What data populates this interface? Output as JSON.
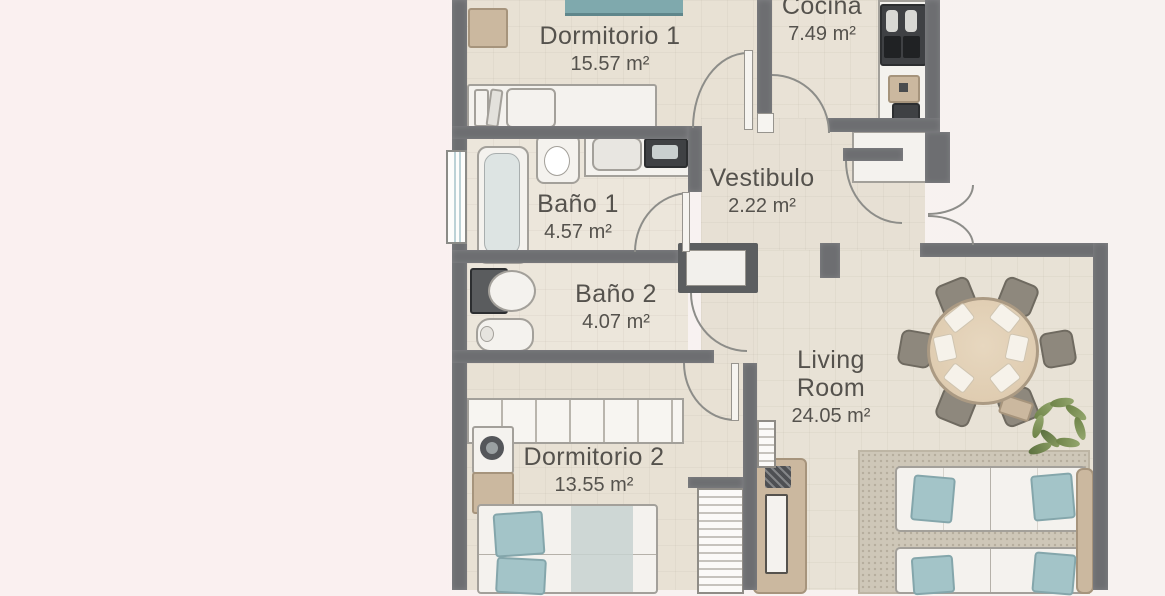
{
  "plan": {
    "kind": "apartment-floor-plan",
    "rooms": [
      {
        "id": "dormitorio-1",
        "name": "Dormitorio 1",
        "area": "15.57 m²"
      },
      {
        "id": "cocina",
        "name": "Cocina",
        "area": "7.49 m²"
      },
      {
        "id": "vestibulo",
        "name": "Vestibulo",
        "area": "2.22 m²"
      },
      {
        "id": "bano-1",
        "name": "Baño 1",
        "area": "4.57 m²"
      },
      {
        "id": "bano-2",
        "name": "Baño 2",
        "area": "4.07 m²"
      },
      {
        "id": "dormitorio-2",
        "name": "Dormitorio 2",
        "area": "13.55 m²"
      },
      {
        "id": "living-room",
        "name": "Living Room",
        "area": "24.05 m²"
      }
    ],
    "colors": {
      "background_left": "#faf0f0",
      "background_right": "#f7f2f0",
      "wall": "#6d6e71",
      "floor": "#e9e2d6",
      "label_text": "#55524d",
      "textile_accent": "#a3c4c8",
      "wood": "#e0ceb5",
      "rug": "#cec7b8",
      "plant": "#7e9257"
    }
  }
}
